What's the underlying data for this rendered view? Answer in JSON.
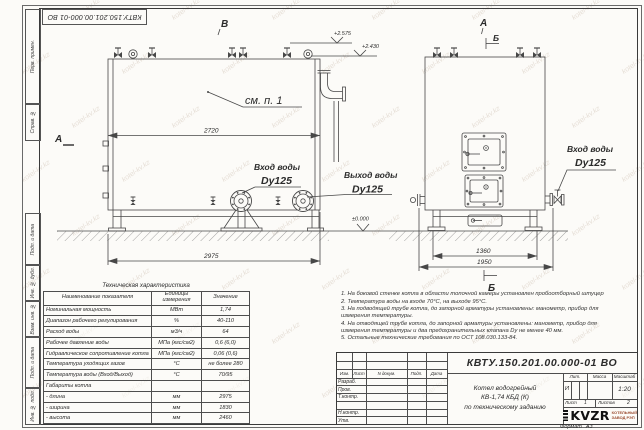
{
  "watermark": {
    "text": "kotel-kv.kz"
  },
  "frame": {
    "stamp_top": "КВТУ.150.201.00.000-01 ВО",
    "margin_items": [
      {
        "label": "Перв. примен."
      },
      {
        "label": "Справ. №"
      },
      {
        "label": "Подп. и дата"
      },
      {
        "label": "Инв. № дубл."
      },
      {
        "label": "Взам. инв. №"
      },
      {
        "label": "Подп. и дата"
      },
      {
        "label": "Инв. № подл."
      }
    ],
    "format_label": "Формат",
    "format_value": "А3"
  },
  "views": {
    "left": {
      "marker_top": "В",
      "marker_side": "А",
      "elev_top": "+2.575",
      "elev_mid": "+2.430",
      "elev_zero": "±0.000",
      "callout_detail": "см. п. 1",
      "dim_top": "2720",
      "dim_bottom": "2975",
      "inlet": {
        "line1": "Вход воды",
        "line2": "Dy125"
      },
      "outlet": {
        "line1": "Выход воды",
        "line2": "Dy125"
      }
    },
    "right": {
      "marker_top": "А",
      "marker_section": "Б",
      "marker_bottom": "Б",
      "dim_inner": "1360",
      "dim_outer": "1950",
      "inlet": {
        "line1": "Вход воды",
        "line2": "Dy125"
      }
    }
  },
  "table": {
    "title": "Техническая характеристика",
    "headers": [
      "Наименование показателя",
      "Единицы измерения",
      "Значение"
    ],
    "rows": [
      [
        "Номинальная мощность",
        "МВт",
        "1,74"
      ],
      [
        "Диапазон рабочего регулирования",
        "%",
        "40-110"
      ],
      [
        "Расход воды",
        "м3/ч",
        "64"
      ],
      [
        "Рабочее давление воды",
        "МПа (кгс/см2)",
        "0,6 (6,0)"
      ],
      [
        "Гидравлическое сопротивление котла",
        "МПа (кгс/см2)",
        "0,06 (0,6)"
      ],
      [
        "Температура уходящих газов",
        "°С",
        "не более 280"
      ],
      [
        "Температура воды (Вход/Выход)",
        "°С",
        "70/95"
      ],
      [
        "Габариты котла",
        "",
        ""
      ],
      [
        "- длина",
        "мм",
        "2975"
      ],
      [
        "- ширина",
        "мм",
        "1830"
      ],
      [
        "- высота",
        "мм",
        "2460"
      ]
    ]
  },
  "notes": {
    "items": [
      "1. На боковой стенке котла в области топочной камеры установлен пробоотборный штуцер",
      "2. Температура воды на входе 70°С, на выходе 95°С.",
      "3. На подводящей трубе котла, до запорной арматуры установлены: манометр, прибор для измерения температуры.",
      "4. На отводящей трубе котла, до запорной арматуры установлены: манометр, прибор для измерения температуры и два предохранительных клапана Dу не менее 40 мм.",
      "5. Остальные технические требования по ОСТ 108.030.133-84."
    ]
  },
  "titleblock": {
    "doc_number": "КВТУ.150.201.00.000-01 ВО",
    "rev_headers": [
      "Изм.",
      "Лист",
      "N докум.",
      "Подп.",
      "Дата"
    ],
    "sig_labels": [
      "Разраб.",
      "Пров.",
      "Т.контр.",
      "",
      "Н.контр.",
      "Утв."
    ],
    "title_line1": "Котел водогрейный",
    "title_line2": "КВ-1,74 КБД (К)",
    "title_line3": "по техническому заданию",
    "lit_header": "Лит.",
    "mass_header": "Масса",
    "scale_header": "Масштаб",
    "lit_value": "И",
    "scale_value": "1:20",
    "sheet_label": "Лист",
    "sheet_value": "1",
    "sheets_label": "Листов",
    "sheets_value": "2",
    "logo_text": "KVZR",
    "company_line1": "КОТЕЛЬНЫЙ",
    "company_line2": "ЗАВОД РЭП"
  }
}
